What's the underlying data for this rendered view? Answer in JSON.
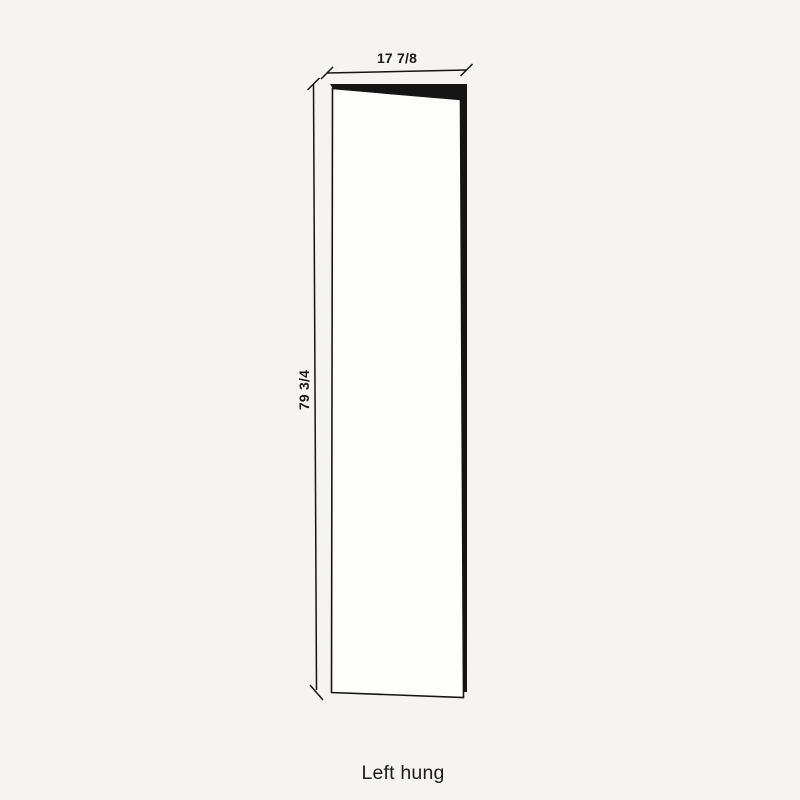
{
  "diagram": {
    "type": "door-elevation",
    "width_label": "17 7/8",
    "height_label": "79 3/4",
    "caption": "Left hung",
    "hinge_side": "left"
  },
  "colors": {
    "background": "#f5f4f2",
    "line": "#151515",
    "door_face": "#fdfdfc",
    "door_edge": "#151515",
    "text": "#1a1a1a"
  }
}
